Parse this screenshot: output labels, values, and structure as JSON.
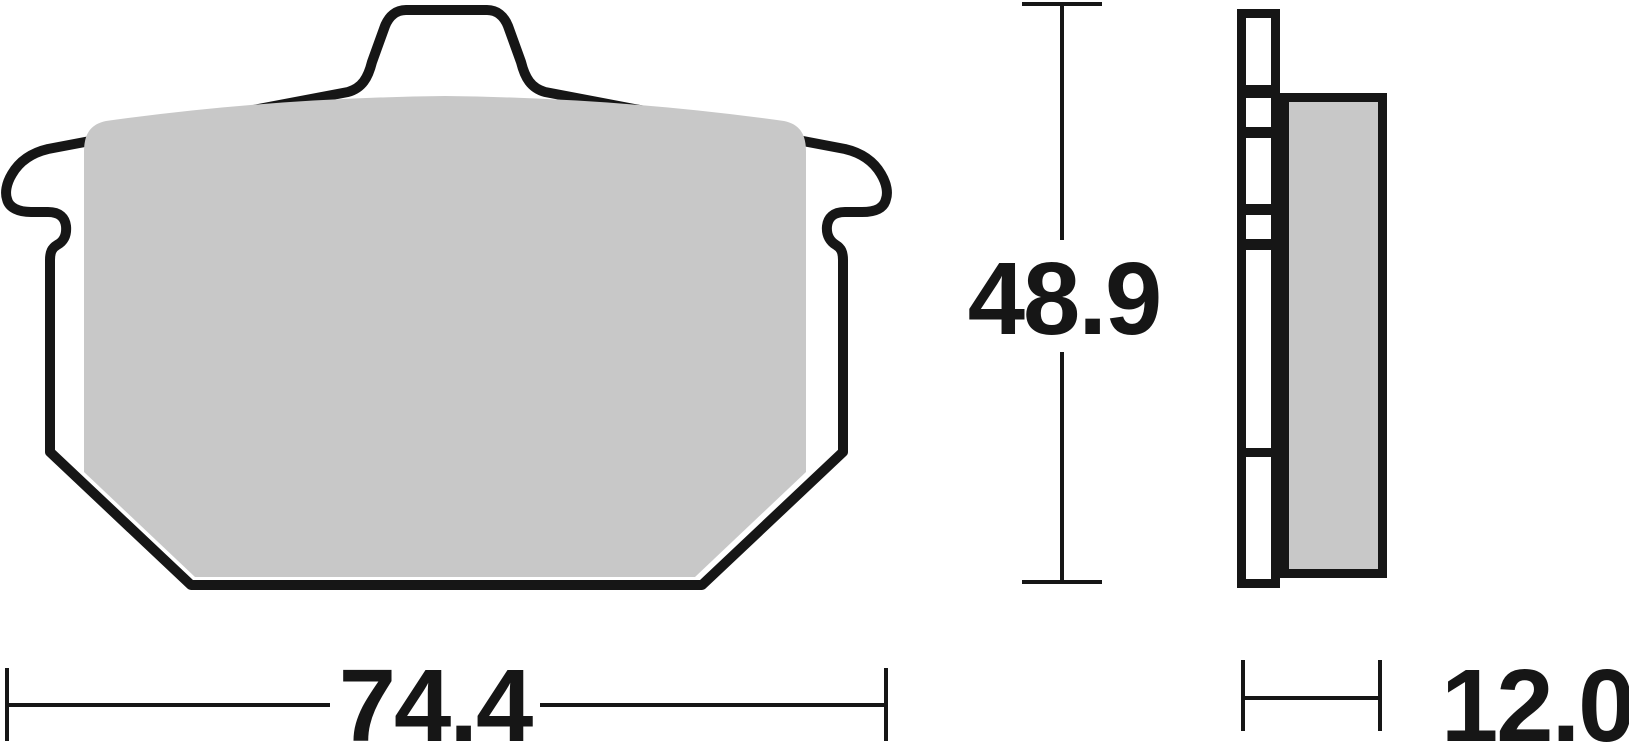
{
  "diagram": {
    "type": "technical-drawing",
    "subject": "brake-pad",
    "dimensions": {
      "width": "74.4",
      "height": "48.9",
      "thickness": "12.0"
    },
    "colors": {
      "outline": "#161616",
      "friction": "#c8c8c8",
      "backplate_fill": "#ffffff",
      "background": "#ffffff"
    }
  }
}
